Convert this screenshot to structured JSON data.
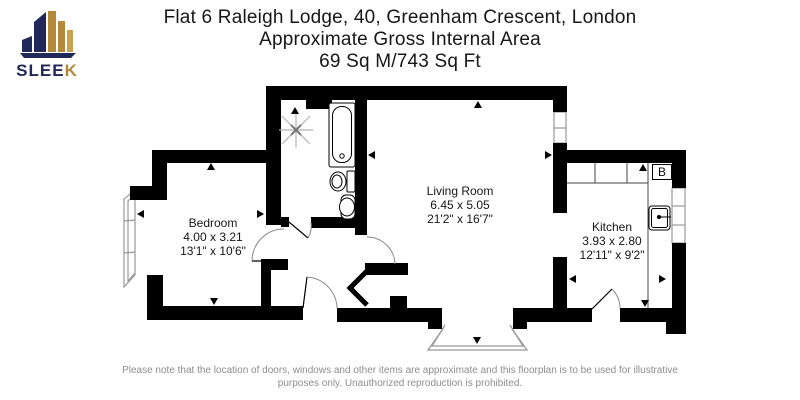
{
  "logo": {
    "brand_prefix": "SLEE",
    "brand_suffix": "K",
    "navy": "#20295a",
    "gold": "#b3893c"
  },
  "header": {
    "line1": "Flat 6 Raleigh Lodge, 40, Greenham Crescent, London",
    "line2": "Approximate Gross Internal Area",
    "line3": "69 Sq M/743 Sq Ft"
  },
  "rooms": [
    {
      "name": "Bedroom",
      "metric": "4.00 x 3.21",
      "imperial": "13'1\" x 10'6\""
    },
    {
      "name": "Living Room",
      "metric": "6.45 x 5.05",
      "imperial": "21'2\" x 16'7\""
    },
    {
      "name": "Kitchen",
      "metric": "3.93 x 2.80",
      "imperial": "12'11\" x 9'2\""
    }
  ],
  "labels": {
    "boiler": "B"
  },
  "footer": {
    "line1": "Please note that the location of doors, windows and other items are approximate and this floorplan is to be used for illustrative",
    "line2": "purposes only. Unauthorized reproduction is prohibited."
  },
  "colors": {
    "wall": "#000000",
    "glazing": "#999999",
    "arc": "#888888",
    "muted": "#8d8d8d"
  }
}
